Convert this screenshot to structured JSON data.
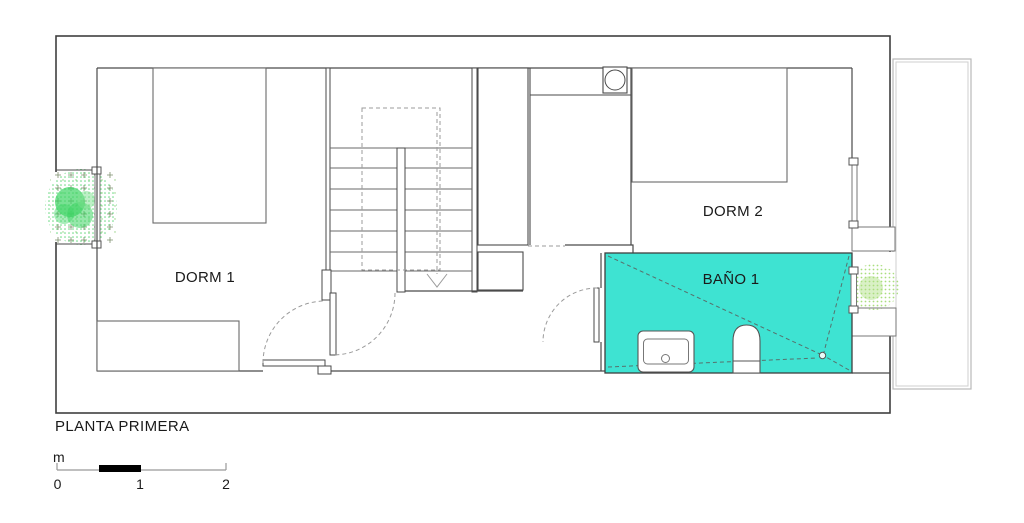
{
  "floor_plan": {
    "title": "PLANTA PRIMERA",
    "rooms": [
      {
        "id": "dorm-1",
        "label": "DORM 1",
        "highlighted": false
      },
      {
        "id": "dorm-2",
        "label": "DORM 2",
        "highlighted": false
      },
      {
        "id": "bano-1",
        "label": "BAÑO 1",
        "highlighted": true
      }
    ]
  },
  "scale_bar": {
    "unit_label": "m",
    "tick_labels": [
      "0",
      "1",
      "2"
    ]
  },
  "colors": {
    "wall": "#3f3f3f",
    "bathroom_highlight": "#3ee3d2",
    "planting_green": "#3fd465",
    "planting_light": "#aade7e",
    "terrace_outline": "#bbbbbb",
    "dashed_gray": "#9b9b9b",
    "scale_bar_black": "#000000"
  }
}
